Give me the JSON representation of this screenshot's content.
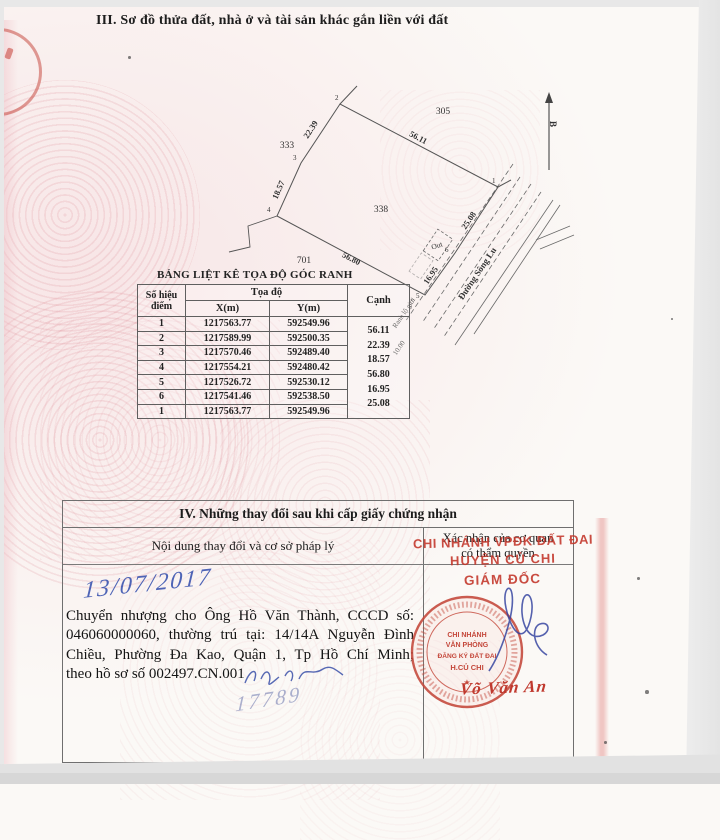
{
  "page": {
    "section3_title": "III. Sơ đồ thửa đất, nhà ở và tài sản khác gắn liền với đất"
  },
  "diagram": {
    "north_label": "B",
    "plot_number": "338",
    "neighbor_plots": [
      "305",
      "333",
      "701"
    ],
    "vertex_labels": [
      "1",
      "2",
      "3",
      "4",
      "5",
      "6"
    ],
    "edge_labels": [
      "56.11",
      "22.39",
      "18.57",
      "56.80",
      "16.95",
      "25.08"
    ],
    "out_label": "Out",
    "road_name": "Đường Sông Lu",
    "corridor_label": "Ranh lộ giới",
    "road_width_label": "10.00"
  },
  "coord_table": {
    "title": "BẢNG LIỆT KÊ TỌA ĐỘ GÓC RANH",
    "col_point": "Số hiệu điểm",
    "col_coords": "Tọa độ",
    "col_x": "X(m)",
    "col_y": "Y(m)",
    "col_edge": "Cạnh",
    "rows": [
      {
        "id": "1",
        "x": "1217563.77",
        "y": "592549.96"
      },
      {
        "id": "2",
        "x": "1217589.99",
        "y": "592500.35"
      },
      {
        "id": "3",
        "x": "1217570.46",
        "y": "592489.40"
      },
      {
        "id": "4",
        "x": "1217554.21",
        "y": "592480.42"
      },
      {
        "id": "5",
        "x": "1217526.72",
        "y": "592530.12"
      },
      {
        "id": "6",
        "x": "1217541.46",
        "y": "592538.50"
      },
      {
        "id": "1",
        "x": "1217563.77",
        "y": "592549.96"
      }
    ],
    "edges": [
      "56.11",
      "22.39",
      "18.57",
      "56.80",
      "16.95",
      "25.08"
    ]
  },
  "section4": {
    "title": "IV. Những thay đổi sau khi cấp giấy chứng nhận",
    "col_content": "Nội dung thay đổi và cơ sở pháp lý",
    "col_confirm_line1": "Xác nhận của cơ quan",
    "col_confirm_line2": "có thẩm quyền",
    "handwritten_date": "13/07/2017",
    "content_lines": [
      "Chuyển nhượng cho Ông Hồ Văn Thành, CCCD số:",
      "046060000060, thường trú tại: 14/14A Nguyễn Đình",
      "Chiều, Phường Đa Kao, Quận 1, Tp Hồ Chí Minh;",
      "theo hồ sơ số 002497.CN.001"
    ],
    "handwritten_number": "17789",
    "stamp_text": [
      "CHI NHÁNH VPĐK ĐẤT ĐAI",
      "HUYỆN CỦ CHI",
      "GIÁM ĐỐC"
    ],
    "seal_center": [
      "CHI NHÁNH",
      "VĂN PHÒNG",
      "ĐĂNG KÝ ĐẤT ĐAI",
      "H.CỦ CHI"
    ],
    "seal_star": "★",
    "signer_name": "Võ Văn An"
  },
  "colors": {
    "stamp_red": "#c33529",
    "ink_blue": "#3a50a8",
    "faint_ink": "#8b94c4"
  }
}
